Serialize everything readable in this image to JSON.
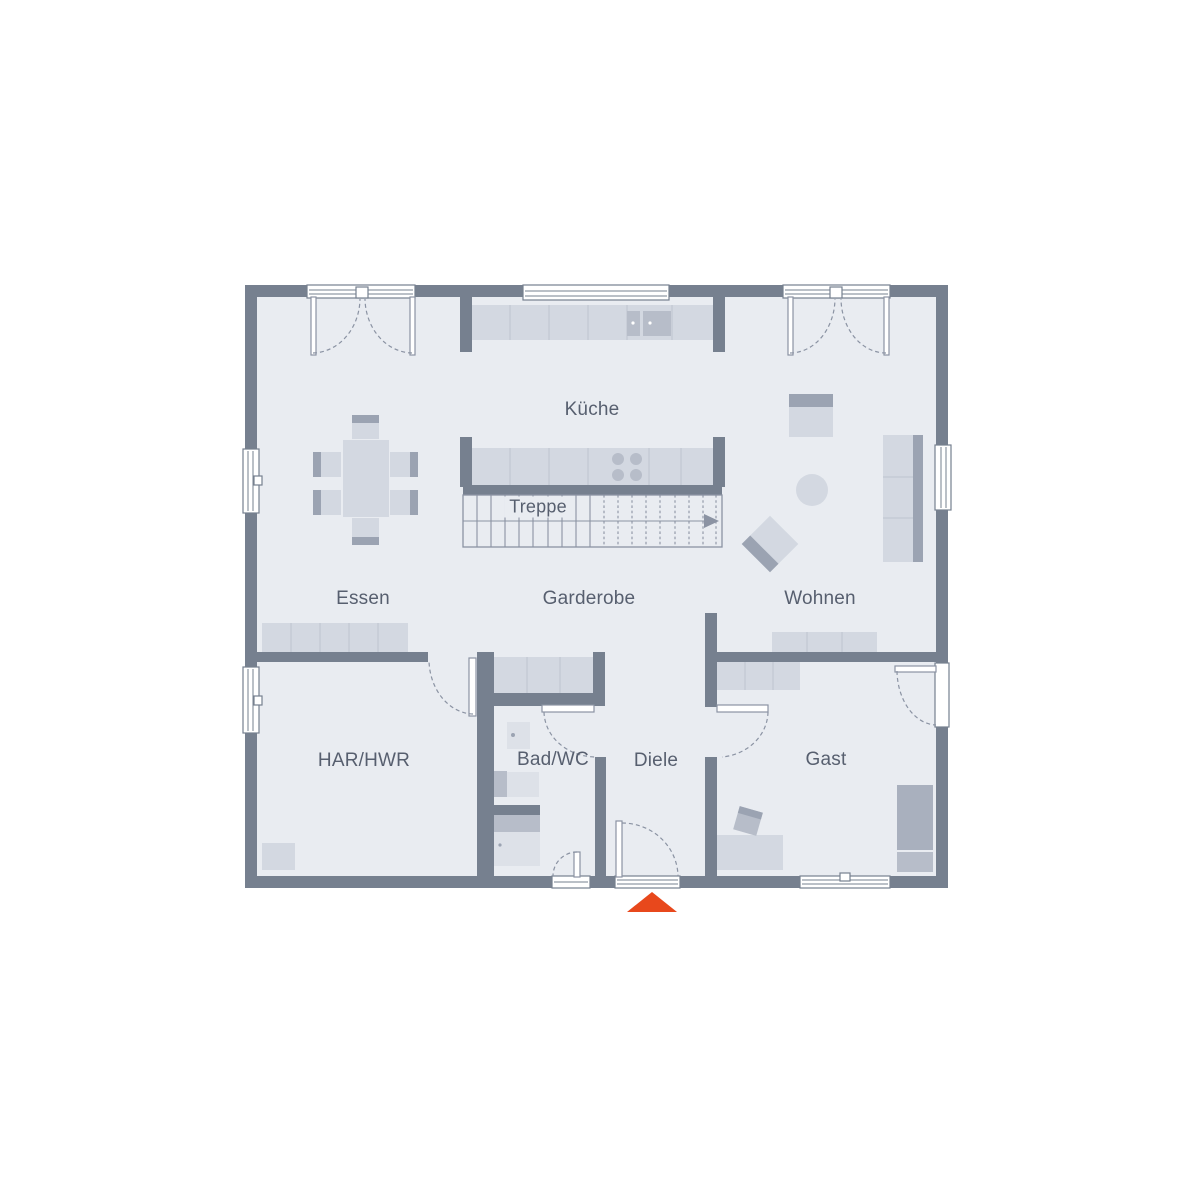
{
  "labels": {
    "kueche": "Küche",
    "treppe": "Treppe",
    "essen": "Essen",
    "garderobe": "Garderobe",
    "wohnen": "Wohnen",
    "har_hwr": "HAR/HWR",
    "bad_wc": "Bad/WC",
    "diele": "Diele",
    "gast": "Gast"
  },
  "colors": {
    "wall": "#76808F",
    "floor": "#E9ECF1",
    "furniture": "#D3D8E1",
    "furniture_soft": "#DDE1E8",
    "furniture_mid": "#B7BDC9",
    "furniture_dark": "#9BA3B2",
    "bed": "#A9B0BE",
    "line": "#8B93A3",
    "divider": "#C2C7D2",
    "text": "#575F6F",
    "accent": "#E8481C",
    "background": "#FFFFFF"
  }
}
